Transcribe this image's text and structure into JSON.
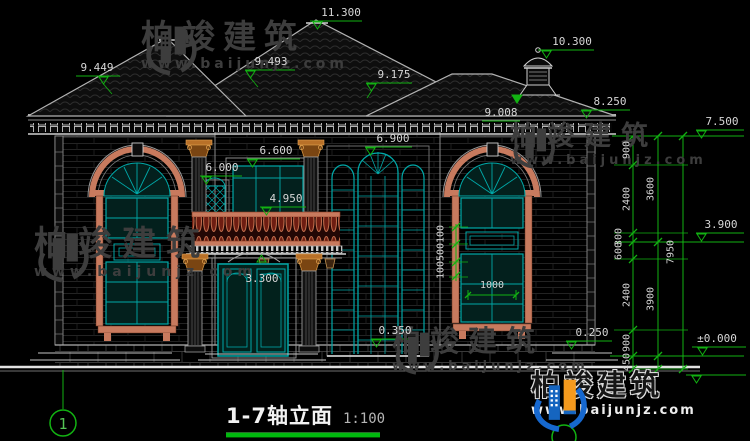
{
  "drawing": {
    "title": "1-7轴立面",
    "scale": "1:100",
    "axis_left": "1"
  },
  "watermark": {
    "brand": "柏竣建筑",
    "url": "www.baijunjz.com"
  },
  "levels": {
    "main_ridge": "11.300",
    "cupola_top": "10.300",
    "left_roof": "9.449",
    "center_roof": "9.493",
    "right_roof_ridge": "9.175",
    "right_roof_eave": "9.008",
    "right_eave": "8.250",
    "cornice_top": "7.500",
    "stair_window_arch": "6.900",
    "upper_window_top": "6.600",
    "lattice_window_top": "6.000",
    "balcony_rail": "4.950",
    "second_floor": "3.900",
    "porch_arch": "3.300",
    "left_plinth": "0.350",
    "right_plinth": "0.250",
    "ground": "±0.000"
  },
  "dims": {
    "window_width": "1000",
    "band": [
      "100",
      "500",
      "100"
    ],
    "chain_inner": [
      "900",
      "2400",
      "300",
      "600",
      "2400",
      "900",
      "450"
    ],
    "chain_mid": [
      "3600",
      "3900"
    ],
    "chain_overall": "7950"
  },
  "colors": {
    "dim_green": "#12b212",
    "window_teal": "#00a8a8",
    "frame_coral": "#c87a5e",
    "capital_orange": "#c08440",
    "logo_blue": "#1565c0",
    "logo_orange": "#f59a1d"
  }
}
